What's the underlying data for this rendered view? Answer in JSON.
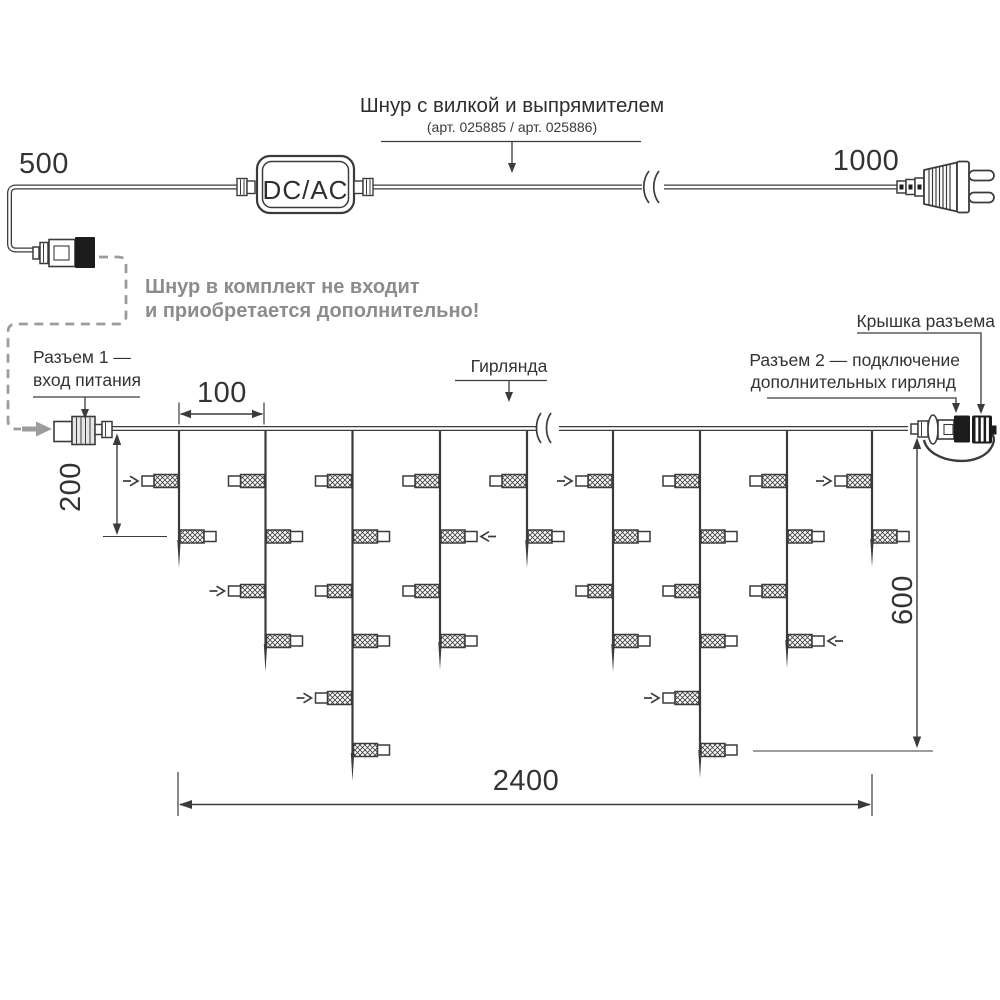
{
  "page": {
    "background": "#ffffff"
  },
  "colors": {
    "line": "#3b3b3b",
    "text": "#333333",
    "muted": "#8c8c8c",
    "fill_black": "#1c1c1c"
  },
  "labels": {
    "cord_title": "Шнур с вилкой и выпрямителем",
    "cord_subtitle": "(арт. 025885 / арт. 025886)",
    "converter": "DC/AC",
    "note_line1": "Шнур в комплект не входит",
    "note_line2": "и приобретается дополнительно!",
    "connector1_line1": "Разъем 1 —",
    "connector1_line2": "вход питания",
    "garland": "Гирлянда",
    "connector2_line1": "Разъем 2 — подключение",
    "connector2_line2": "дополнительных гирлянд",
    "connector_cap": "Крышка разъема"
  },
  "dimensions": {
    "cord_left_mm": "500",
    "cord_right_mm": "1000",
    "drop_spacing_mm": "100",
    "short_drop_mm": "200",
    "long_drop_mm": "600",
    "total_length_mm": "2400"
  },
  "garland": {
    "wire_y": 428.5,
    "x_start": 112,
    "x_end": 908,
    "row_y": [
      481,
      536.5,
      591,
      641,
      698,
      750
    ],
    "drops": [
      {
        "x": 179,
        "tip": 568,
        "lamps": [
          {
            "row": 0,
            "side": "left",
            "arrow": true
          },
          {
            "row": 1,
            "side": "right",
            "arrow": false
          }
        ]
      },
      {
        "x": 265.5,
        "tip": 672,
        "lamps": [
          {
            "row": 0,
            "side": "left",
            "arrow": false
          },
          {
            "row": 1,
            "side": "right",
            "arrow": false
          },
          {
            "row": 2,
            "side": "left",
            "arrow": true
          },
          {
            "row": 3,
            "side": "right",
            "arrow": false
          }
        ]
      },
      {
        "x": 352.5,
        "tip": 781,
        "lamps": [
          {
            "row": 0,
            "side": "left",
            "arrow": false
          },
          {
            "row": 1,
            "side": "right",
            "arrow": false
          },
          {
            "row": 2,
            "side": "left",
            "arrow": false
          },
          {
            "row": 3,
            "side": "right",
            "arrow": false
          },
          {
            "row": 4,
            "side": "left",
            "arrow": true
          },
          {
            "row": 5,
            "side": "right",
            "arrow": false
          }
        ]
      },
      {
        "x": 440,
        "tip": 670,
        "lamps": [
          {
            "row": 0,
            "side": "left",
            "arrow": false
          },
          {
            "row": 1,
            "side": "right",
            "arrow": true
          },
          {
            "row": 2,
            "side": "left",
            "arrow": false
          },
          {
            "row": 3,
            "side": "right",
            "arrow": false
          }
        ]
      },
      {
        "x": 527,
        "tip": 568,
        "lamps": [
          {
            "row": 0,
            "side": "left",
            "arrow": false
          },
          {
            "row": 1,
            "side": "right",
            "arrow": false
          }
        ]
      },
      {
        "x": 613,
        "tip": 672,
        "lamps": [
          {
            "row": 0,
            "side": "left",
            "arrow": true
          },
          {
            "row": 1,
            "side": "right",
            "arrow": false
          },
          {
            "row": 2,
            "side": "left",
            "arrow": false
          },
          {
            "row": 3,
            "side": "right",
            "arrow": false
          }
        ]
      },
      {
        "x": 700,
        "tip": 778,
        "lamps": [
          {
            "row": 0,
            "side": "left",
            "arrow": false
          },
          {
            "row": 1,
            "side": "right",
            "arrow": false
          },
          {
            "row": 2,
            "side": "left",
            "arrow": false
          },
          {
            "row": 3,
            "side": "right",
            "arrow": false
          },
          {
            "row": 4,
            "side": "left",
            "arrow": true
          },
          {
            "row": 5,
            "side": "right",
            "arrow": false
          }
        ]
      },
      {
        "x": 787,
        "tip": 668,
        "lamps": [
          {
            "row": 0,
            "side": "left",
            "arrow": false
          },
          {
            "row": 1,
            "side": "right",
            "arrow": false
          },
          {
            "row": 2,
            "side": "left",
            "arrow": false
          },
          {
            "row": 3,
            "side": "right",
            "arrow": true
          }
        ]
      },
      {
        "x": 872,
        "tip": 567,
        "lamps": [
          {
            "row": 0,
            "side": "left",
            "arrow": true
          },
          {
            "row": 1,
            "side": "right",
            "arrow": false
          }
        ]
      }
    ]
  }
}
